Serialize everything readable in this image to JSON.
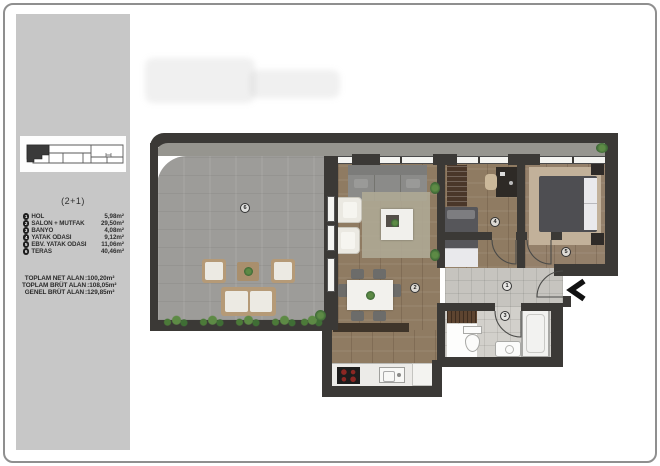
{
  "sidebar": {
    "plan_type": "(2+1)",
    "legend": [
      {
        "num": "1",
        "label": "HOL",
        "area": "5,98m²"
      },
      {
        "num": "2",
        "label": "SALON + MUTFAK",
        "area": "29,50m²"
      },
      {
        "num": "3",
        "label": "BANYO",
        "area": "4,08m²"
      },
      {
        "num": "4",
        "label": "YATAK ODASI",
        "area": "9,12m²"
      },
      {
        "num": "5",
        "label": "EBV. YATAK ODASI",
        "area": "11,06m²"
      },
      {
        "num": "6",
        "label": "TERAS",
        "area": "40,46m²"
      }
    ],
    "totals": [
      {
        "label": "TOPLAM NET ALAN",
        "value": ":100,20m²"
      },
      {
        "label": "TOPLAM BRÜT ALAN",
        "value": ":108,05m²"
      },
      {
        "label": "GENEL BRÜT ALAN",
        "value": ":129,85m²"
      }
    ]
  },
  "plan": {
    "markers": [
      {
        "num": "1"
      },
      {
        "num": "2"
      },
      {
        "num": "3"
      },
      {
        "num": "4"
      },
      {
        "num": "5"
      },
      {
        "num": "6"
      }
    ],
    "entrance_arrow_icon": "chevron-left-icon"
  },
  "colors": {
    "wall": "#3b3936",
    "wood_floor": "#8f7b62",
    "stone_floor": "#9d9c99",
    "tile_floor": "#c6c4bf",
    "sidebar_bg": "#c7c7c7",
    "plant_green": "#4c7a39",
    "unit_highlight": "#3a3a3a"
  }
}
